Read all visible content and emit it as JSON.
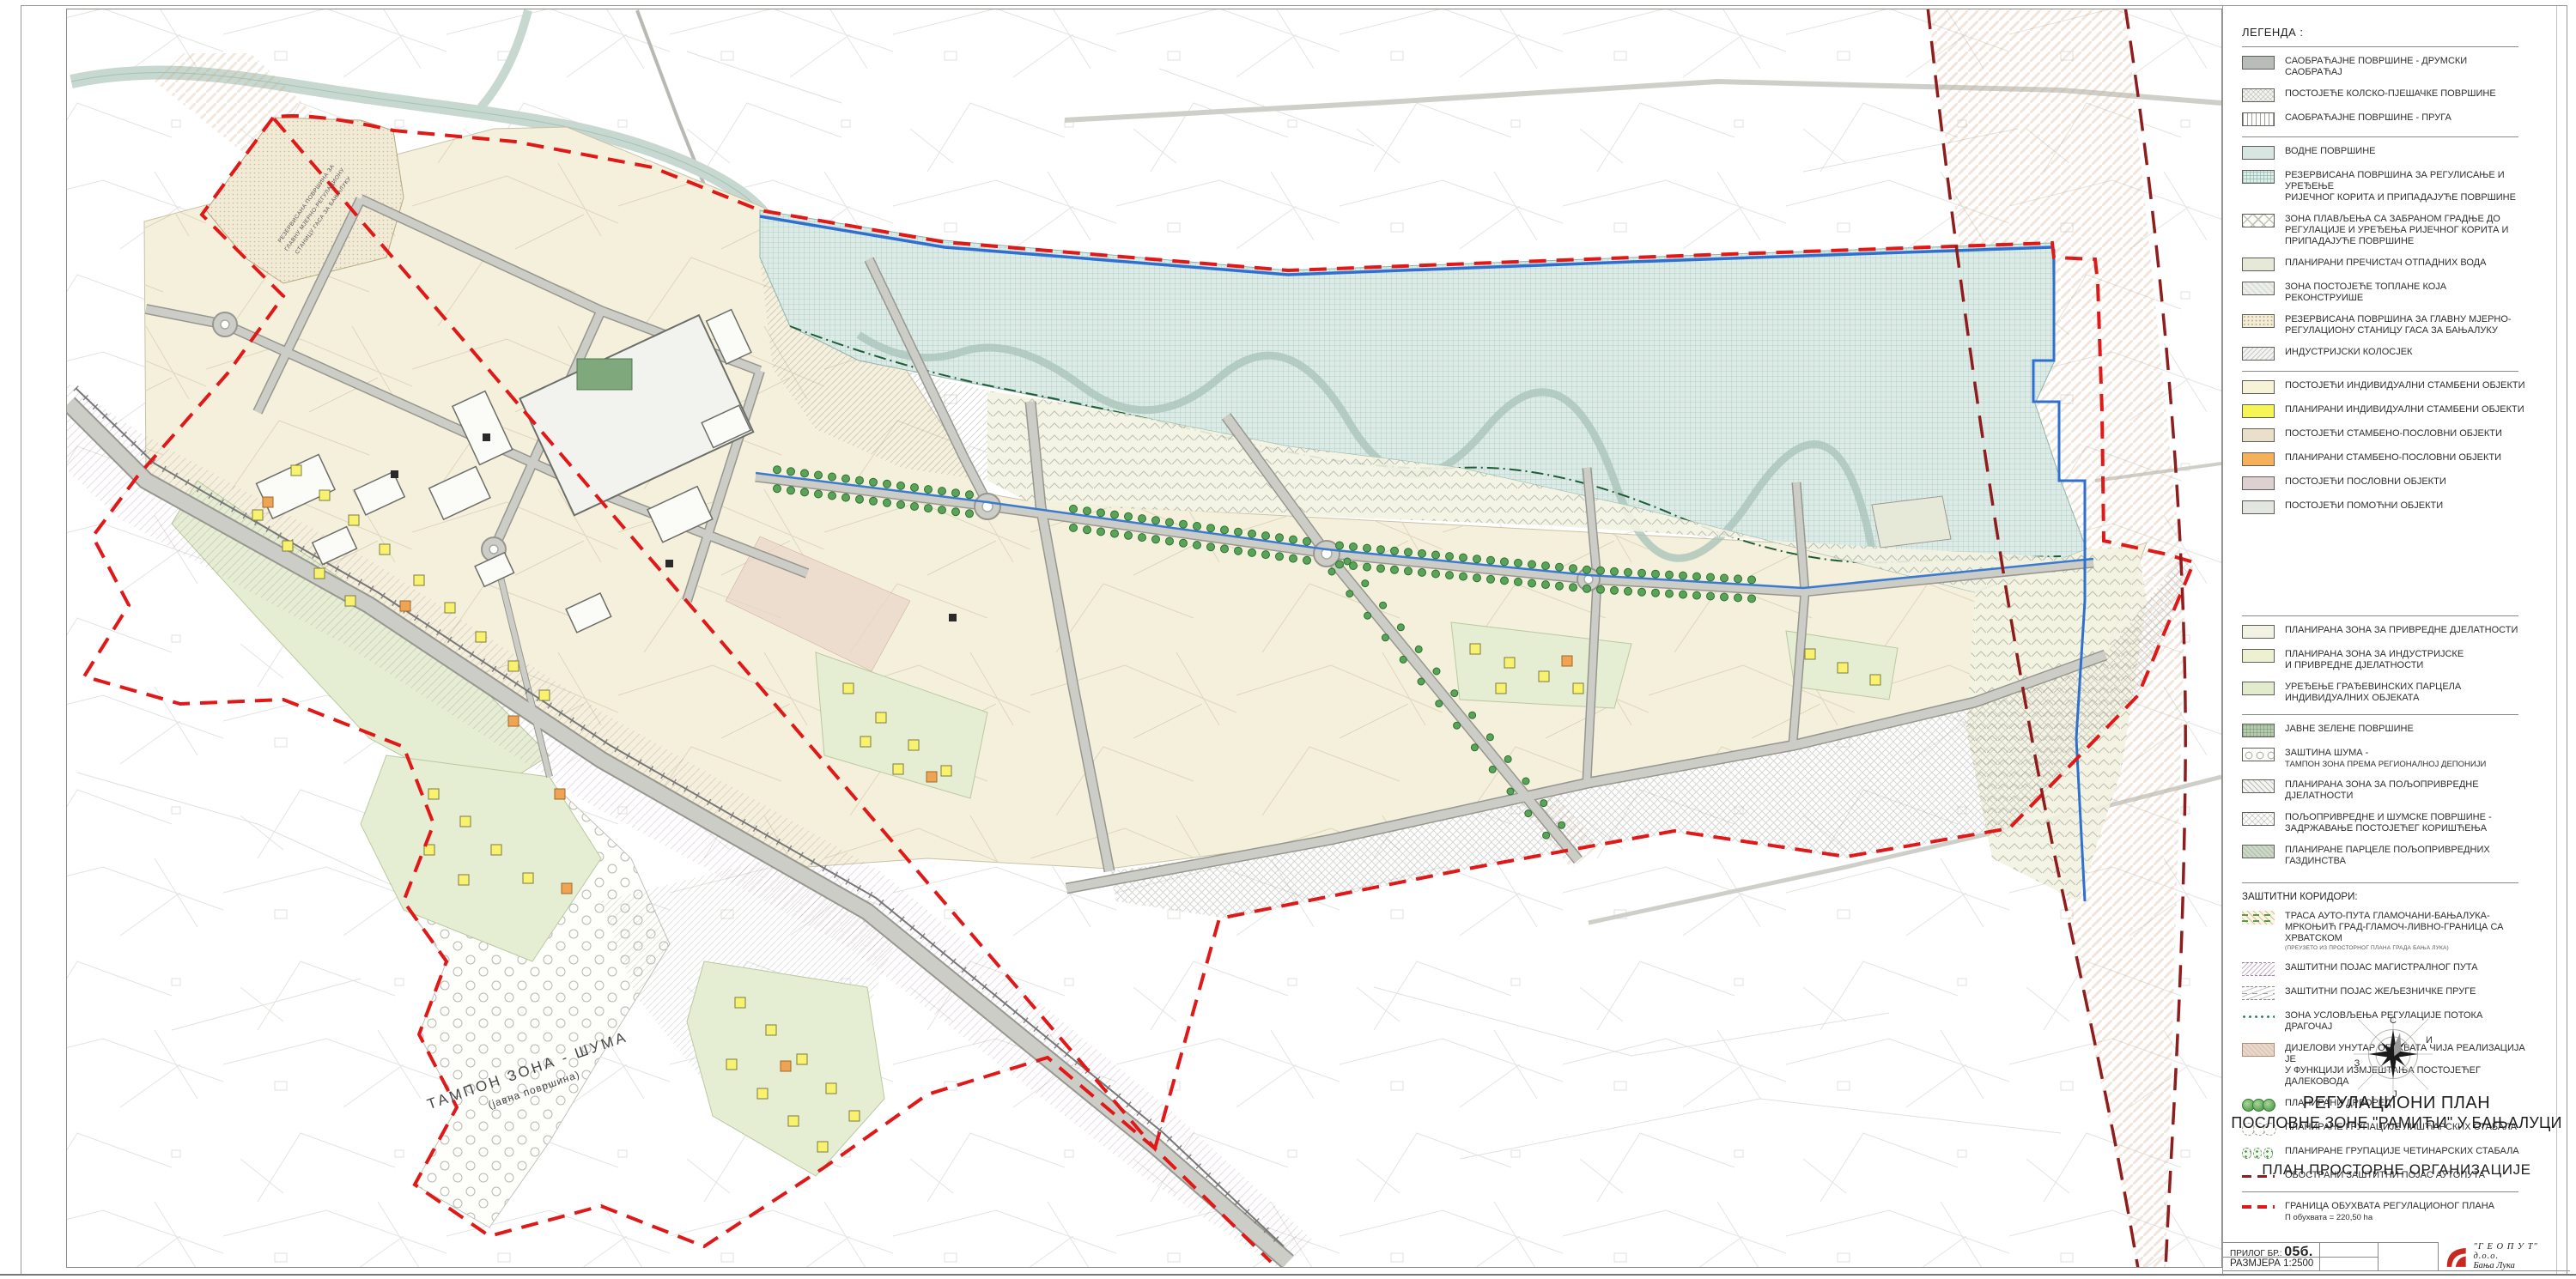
{
  "colors": {
    "boundary_red": "#e01818",
    "autoput_dark_red": "#8f1d1d",
    "water_blue": "#2f6fd0",
    "river_teal": "#dcebe6",
    "zone_beige": "#f5f0dc",
    "planned_house_yellow": "#f7f457",
    "planned_mixed_orange": "#f4b159",
    "tree_green": "#57a857"
  },
  "legend": {
    "title": "ЛЕГЕНДА :",
    "sections": [
      {
        "key": "transport",
        "rule": true,
        "items": [
          {
            "sw": "sw-road",
            "label": "САОБРАЋАЈНЕ ПОВРШИНЕ - ДРУМСКИ САОБРАЋАЈ"
          },
          {
            "sw": "sw-pedestrian",
            "label": "ПОСТОЈЕЋЕ КОЛСКО-ПЈЕШАЧКЕ ПОВРШИНЕ"
          },
          {
            "sw": "sw-rail",
            "label": "САОБРАЋАЈНЕ ПОВРШИНЕ - ПРУГА"
          }
        ]
      },
      {
        "key": "water",
        "rule": true,
        "items": [
          {
            "sw": "sw-water",
            "label": "ВОДНЕ ПОВРШИНЕ"
          },
          {
            "sw": "sw-river",
            "label": "РЕЗЕРВИСАНА ПОВРШИНА ЗА РЕГУЛИСАЊЕ И УРЕЂЕЊЕ\nРИЈЕЧНОГ КОРИТА И ПРИПАДАЈУЋЕ ПОВРШИНЕ"
          },
          {
            "sw": "sw-flood",
            "label": "ЗОНА ПЛАВЉЕЊА СА ЗАБРАНОМ ГРАДЊЕ ДО\nРЕГУЛАЦИЈЕ И УРЕЂЕЊА РИЈЕЧНОГ КОРИТА И\nПРИПАДАЈУЋЕ ПОВРШИНЕ"
          },
          {
            "sw": "sw-wwtp",
            "label": "ПЛАНИРАНИ ПРЕЧИСТАЧ ОТПАДНИХ ВОДА"
          },
          {
            "sw": "sw-heating",
            "label": "ЗОНА ПОСТОЈЕЋЕ ТОПЛАНЕ КОЈА РЕКОНСТРУИШЕ"
          },
          {
            "sw": "sw-gas",
            "label": "РЕЗЕРВИСАНА ПОВРШИНА ЗА ГЛАВНУ МЈЕРНО-\nРЕГУЛАЦИОНУ СТАНИЦУ ГАСА ЗА БАЊАЛУКУ"
          },
          {
            "sw": "sw-siding",
            "label": "ИНДУСТРИЈСКИ КОЛОСЈЕК"
          }
        ]
      },
      {
        "key": "buildings",
        "rule": true,
        "items": [
          {
            "sw": "sw-exist-house",
            "label": "ПОСТОЈЕЋИ ИНДИВИДУАЛНИ СТАМБЕНИ ОБЈЕКТИ"
          },
          {
            "sw": "sw-plan-house",
            "label": "ПЛАНИРАНИ ИНДИВИДУАЛНИ СТАМБЕНИ ОБЈЕКТИ"
          },
          {
            "sw": "sw-exist-mixed",
            "label": "ПОСТОЈЕЋИ СТАМБЕНО-ПОСЛОВНИ ОБЈЕКТИ"
          },
          {
            "sw": "sw-plan-mixed",
            "label": "ПЛАНИРАНИ СТАМБЕНО-ПОСЛОВНИ ОБЈЕКТИ"
          },
          {
            "sw": "sw-exist-business",
            "label": "ПОСТОЈЕЋИ ПОСЛОВНИ ОБЈЕКТИ"
          },
          {
            "sw": "sw-exist-aux",
            "label": "ПОСТОЈЕЋИ ПОМОЋНИ ОБЈЕКТИ"
          }
        ]
      },
      {
        "key": "planned",
        "rule": true,
        "items": [
          {
            "sw": "sw-econ",
            "label": "ПЛАНИРАНА ЗОНА ЗА ПРИВРЕДНЕ ДЈЕЛАТНОСТИ"
          },
          {
            "sw": "sw-industry",
            "label": "ПЛАНИРАНА ЗОНА ЗА ИНДУСТРИЈСКЕ\nИ ПРИВРЕДНЕ ДЈЕЛАТНОСТИ"
          },
          {
            "sw": "sw-parcels-ind",
            "label": "УРЕЂЕЊЕ ГРАЂЕВИНСКИХ ПАРЦЕЛА\nИНДИВИДУАЛНИХ ОБЈЕКАТА"
          }
        ]
      },
      {
        "key": "greenag",
        "rule": true,
        "items": [
          {
            "sw": "sw-green",
            "label": "ЈАВНЕ ЗЕЛЕНЕ ПОВРШИНЕ"
          },
          {
            "sw": "sw-forest",
            "label": "ЗАШТИНА ШУМА -",
            "small": "ТАМПОН ЗОНА ПРЕМА РЕГИОНАЛНОЈ ДЕПОНИЈИ"
          },
          {
            "sw": "sw-agri",
            "label": "ПЛАНИРАНА ЗОНА ЗА ПОЉОПРИВРЕДНЕ ДЈЕЛАТНОСТИ"
          },
          {
            "sw": "sw-agri-forest",
            "label": "ПОЉОПРИВРЕДНЕ И ШУМСКЕ ПОВРШИНЕ -\nЗАДРЖАВАЊЕ ПОСТОЈЕЋЕГ КОРИШЋЕЊА"
          },
          {
            "sw": "sw-agri-parcels",
            "label": "ПЛАНИРАНЕ ПАРЦЕЛЕ ПОЉОПРИВРЕДНИХ ГАЗДИНСТВА"
          }
        ]
      },
      {
        "key": "corridors",
        "rule": true,
        "heading": "ЗАШТИТНИ КОРИДОРИ:",
        "items": [
          {
            "sw": "sw-highway",
            "label": "ТРАСА АУТО-ПУТА ГЛАМОЧАНИ-БАЊАЛУКА-\nМРКОЊИЋ ГРАД-ГЛАМОЧ-ЛИВНО-ГРАНИЦА СА ХРВАТСКОМ",
            "tiny": "(ПРЕУЗЕТО ИЗ ПРОСТОРНОГ ПЛАНА ГРАДА БАЊА ЛУКА)"
          },
          {
            "sw": "sw-magroad",
            "label": "ЗАШТИТНИ ПОЈАС МАГИСТРАЛНОГ ПУТА"
          },
          {
            "sw": "sw-railzone",
            "label": "ЗАШТИТНИ ПОЈАС ЖЕЉЕЗНИЧКЕ ПРУГЕ"
          },
          {
            "sw": "sw-dots",
            "label": "ЗОНА УСЛОВЉЕЊА РЕГУЛАЦИЈЕ ПОТОКА ДРАГОЧАЈ"
          },
          {
            "sw": "sw-powerline",
            "label": "ДИЈЕЛОВИ УНУТАР ОБУХВАТА ЧИЈА РЕАЛИЗАЦИЈА ЈЕ\nУ ФУНКЦИЈИ ИЗМЈЕШТАЊА ПОСТОЈЕЋЕГ ДАЛЕКОВОДА"
          },
          {
            "sw": "trees",
            "label": "ПЛАНИРАНИ ДРВОРЕД"
          },
          {
            "sw": "trees-outline",
            "label": "ПЛАНИРАНЕ ГРУПАЦИЈЕ ЛИШЋАРСКИХ СТАБАЛА"
          },
          {
            "sw": "conifer",
            "label": "ПЛАНИРАНЕ ГРУПАЦИЈЕ ЧЕТИНАРСКИХ СТАБАЛА"
          },
          {
            "sw": "sw-lineDark",
            "label": "ОБОСТРАНИ ЗАШТИТНИ ПОЈАС АУТОПУТА"
          }
        ]
      },
      {
        "key": "boundary",
        "rule": true,
        "items": [
          {
            "sw": "sw-lineRed",
            "label": "ГРАНИЦА ОБУХВАТА РЕГУЛАЦИОНОГ ПЛАНА",
            "small": "П обухвата = 220,50 ha"
          }
        ]
      }
    ]
  },
  "title_block": {
    "compass": {
      "n": "С",
      "e": "И",
      "w": "З",
      "s": "Ј"
    },
    "line1": "РЕГУЛАЦИОНИ ПЛАН",
    "line2": "ПОСЛОВНЕ ЗОНЕ \"РАМИЋИ\" У БАЊАЛУЦИ",
    "subtitle": "ПЛАН ПРОСТОРНЕ ОРГАНИЗАЦИЈЕ"
  },
  "footer": {
    "attachment_label": "ПРИЛОГ БР.:",
    "attachment_no": "05б.",
    "scale": "РАЗМЈЕРА 1:2500",
    "company": "\"Г Е О П У Т\" д.о.о.",
    "company_city": "Бања Лука"
  },
  "map": {
    "labels": {
      "gas_l1": "РЕЗЕРВИСАНА ПОВРШИНА ЗА",
      "gas_l2": "ГЛАВНУ МЈЕРНО-РЕГУЛАЦИОНУ",
      "gas_l3": "СТАНИЦУ ГАСА ЗА БАЊАЛУКУ",
      "tampon_l1": "ТАМПОН  ЗОНА - ШУМА",
      "tampon_l2": "(јавна површина)"
    }
  }
}
